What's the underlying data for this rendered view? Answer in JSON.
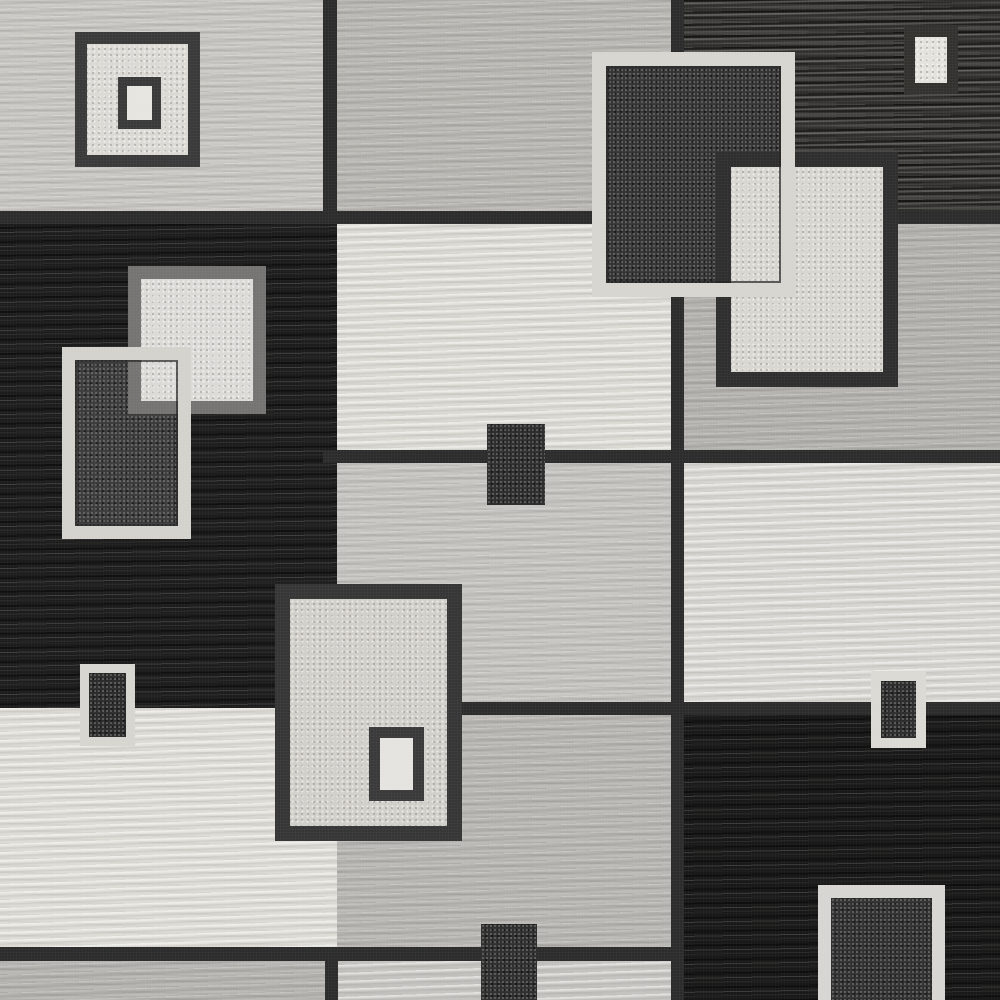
{
  "image_type": "natural-photo",
  "subject": "Top-down photo of a modern abstract geometric area rug with a grid of gray, charcoal, black and cream blocks overlaid with bordered square and rectangle motifs",
  "canvas": {
    "width": 1000,
    "height": 1000,
    "background": "#1a1a1a"
  },
  "palette": {
    "light_gray_panel": "#c7c5c0",
    "medium_gray_panel": "#b3b1ad",
    "off_white_panel": "#dcdad4",
    "charcoal_striated_panel": "#434240",
    "black_panel": "#1c1c1c",
    "grid_line": "#2c2c2c",
    "cream_border": "#d6d4ce",
    "dark_border": "#383838",
    "gray_border": "#767472",
    "dark_motif_fill": "#343434",
    "white_motif_fill": "#e5e3df"
  },
  "panels": [
    {
      "name": "panel-top-left-lightgray",
      "x": 0,
      "y": 0,
      "w": 337,
      "h": 218,
      "bg": "#c7c5c0",
      "tex": "tex-streak"
    },
    {
      "name": "panel-top-middle-gray",
      "x": 337,
      "y": 0,
      "w": 341,
      "h": 218,
      "bg": "#b6b4af",
      "tex": "tex-streak"
    },
    {
      "name": "panel-top-right-charcoal",
      "x": 678,
      "y": 0,
      "w": 322,
      "h": 218,
      "bg": "#434240",
      "tex": "tex-darkstriate"
    },
    {
      "name": "panel-left-black",
      "x": 0,
      "y": 218,
      "w": 337,
      "h": 490,
      "bg": "#1c1c1c",
      "tex": "tex-blackstriate"
    },
    {
      "name": "panel-middle-offwhite",
      "x": 337,
      "y": 218,
      "w": 341,
      "h": 243,
      "bg": "#dcdad4",
      "tex": "tex-streak2"
    },
    {
      "name": "panel-right-gray",
      "x": 678,
      "y": 218,
      "w": 322,
      "h": 243,
      "bg": "#b1afab",
      "tex": "tex-streak"
    },
    {
      "name": "panel-middle-lightgray",
      "x": 337,
      "y": 461,
      "w": 341,
      "h": 254,
      "bg": "#c4c2be",
      "tex": "tex-streak"
    },
    {
      "name": "panel-middle-gray-lower",
      "x": 337,
      "y": 715,
      "w": 341,
      "h": 242,
      "bg": "#b6b4b0",
      "tex": "tex-streak"
    },
    {
      "name": "panel-right-offwhite",
      "x": 678,
      "y": 461,
      "w": 322,
      "h": 254,
      "bg": "#d8d6d1",
      "tex": "tex-streak2"
    },
    {
      "name": "panel-left-offwhite",
      "x": 0,
      "y": 708,
      "w": 337,
      "h": 249,
      "bg": "#dedcd6",
      "tex": "tex-streak2"
    },
    {
      "name": "panel-right-black",
      "x": 678,
      "y": 712,
      "w": 322,
      "h": 288,
      "bg": "#181818",
      "tex": "tex-blackstriate"
    },
    {
      "name": "panel-bottom-left-strip",
      "x": 0,
      "y": 957,
      "w": 337,
      "h": 43,
      "bg": "#b3b1ad",
      "tex": "tex-streak"
    },
    {
      "name": "panel-bottom-middle-strip",
      "x": 337,
      "y": 957,
      "w": 341,
      "h": 43,
      "bg": "#c6c4c0",
      "tex": "tex-streak2"
    }
  ],
  "grid_lines": [
    {
      "name": "grid-hline-upper",
      "x": 0,
      "y": 211,
      "w": 1000,
      "h": 13,
      "bg": "#2c2c2c"
    },
    {
      "name": "grid-hline-center",
      "x": 323,
      "y": 450,
      "w": 677,
      "h": 13,
      "bg": "#2c2c2c"
    },
    {
      "name": "grid-hline-lower",
      "x": 337,
      "y": 702,
      "w": 663,
      "h": 13,
      "bg": "#2c2c2c"
    },
    {
      "name": "grid-hline-bottom",
      "x": 0,
      "y": 947,
      "w": 678,
      "h": 14,
      "bg": "#2c2c2c"
    },
    {
      "name": "grid-vline-left-top",
      "x": 323,
      "y": 0,
      "w": 14,
      "h": 224,
      "bg": "#2c2c2c"
    },
    {
      "name": "grid-vline-right-full",
      "x": 671,
      "y": 0,
      "w": 13,
      "h": 1000,
      "bg": "#2c2c2c"
    },
    {
      "name": "grid-vline-left-bottom",
      "x": 325,
      "y": 957,
      "w": 13,
      "h": 43,
      "bg": "#2c2c2c"
    }
  ],
  "motifs": [
    {
      "name": "motif-nested-square-outer",
      "x": 75,
      "y": 32,
      "w": 125,
      "h": 135,
      "bg": "#dbd9d4",
      "border": "12px solid #3a3a3a",
      "tex": "tex-speckle"
    },
    {
      "name": "motif-nested-square-inner",
      "x": 118,
      "y": 77,
      "w": 43,
      "h": 52,
      "bg": "#e7e5df",
      "border": "9px solid #3a3a3a"
    },
    {
      "name": "motif-topright-white-rect",
      "x": 904,
      "y": 26,
      "w": 54,
      "h": 68,
      "bg": "#e4e2dc",
      "border": "11px solid #33322f",
      "tex": "tex-speckle"
    },
    {
      "name": "motif-top-overlap-dark-fill",
      "x": 592,
      "y": 52,
      "w": 203,
      "h": 245,
      "bg": "#343434",
      "tex": "tex-sparkle"
    },
    {
      "name": "motif-top-overlap-cream-rect",
      "x": 716,
      "y": 152,
      "w": 182,
      "h": 235,
      "bg": "#d8d6d0",
      "border": "15px solid #2f2f2f",
      "tex": "tex-speckle"
    },
    {
      "name": "motif-top-overlap-cream-frame",
      "x": 592,
      "y": 52,
      "w": 203,
      "h": 245,
      "bg": "transparent",
      "border": "14px solid #d7d5cf",
      "shadow": "inset 0 0 0 2px rgba(35,35,35,0.7)"
    },
    {
      "name": "motif-left-overlap-dark-fill",
      "x": 62,
      "y": 347,
      "w": 129,
      "h": 192,
      "bg": "#3b3b3b",
      "tex": "tex-sparkle"
    },
    {
      "name": "motif-left-white-square",
      "x": 128,
      "y": 266,
      "w": 138,
      "h": 148,
      "bg": "#dcdad6",
      "border": "13px solid #767472",
      "tex": "tex-speckle"
    },
    {
      "name": "motif-left-overlap-cream-frame",
      "x": 62,
      "y": 347,
      "w": 129,
      "h": 192,
      "bg": "transparent",
      "border": "13px solid #d4d2cc",
      "shadow": "inset 0 0 0 2px rgba(35,35,35,0.7)"
    },
    {
      "name": "motif-center-dark-block",
      "x": 487,
      "y": 424,
      "w": 58,
      "h": 81,
      "bg": "#2d2d2d",
      "tex": "tex-sparkle"
    },
    {
      "name": "motif-bottom-big-rect",
      "x": 275,
      "y": 584,
      "w": 187,
      "h": 257,
      "bg": "#d1cfc9",
      "border": "15px solid #363636",
      "tex": "tex-speckle"
    },
    {
      "name": "motif-bottom-big-inner-rect",
      "x": 369,
      "y": 727,
      "w": 55,
      "h": 74,
      "bg": "#e5e3df",
      "border": "11px solid #3a3a3a"
    },
    {
      "name": "motif-bottomleft-small-rect",
      "x": 80,
      "y": 664,
      "w": 55,
      "h": 82,
      "bg": "#2b2b2b",
      "border": "9px solid #d7d5cf",
      "tex": "tex-sparkle"
    },
    {
      "name": "motif-bottomcenter-small-rect",
      "x": 481,
      "y": 924,
      "w": 56,
      "h": 76,
      "bg": "#2e2e2e",
      "tex": "tex-sparkle"
    },
    {
      "name": "motif-bottomright-small-rect",
      "x": 871,
      "y": 671,
      "w": 55,
      "h": 77,
      "bg": "#2c2c2c",
      "border": "10px solid #dbd9d3",
      "tex": "tex-sparkle"
    },
    {
      "name": "motif-bottomright-large-rect",
      "x": 818,
      "y": 885,
      "w": 127,
      "h": 130,
      "bg": "#303030",
      "border": "13px solid #d8d6d2",
      "tex": "tex-sparkle"
    }
  ]
}
